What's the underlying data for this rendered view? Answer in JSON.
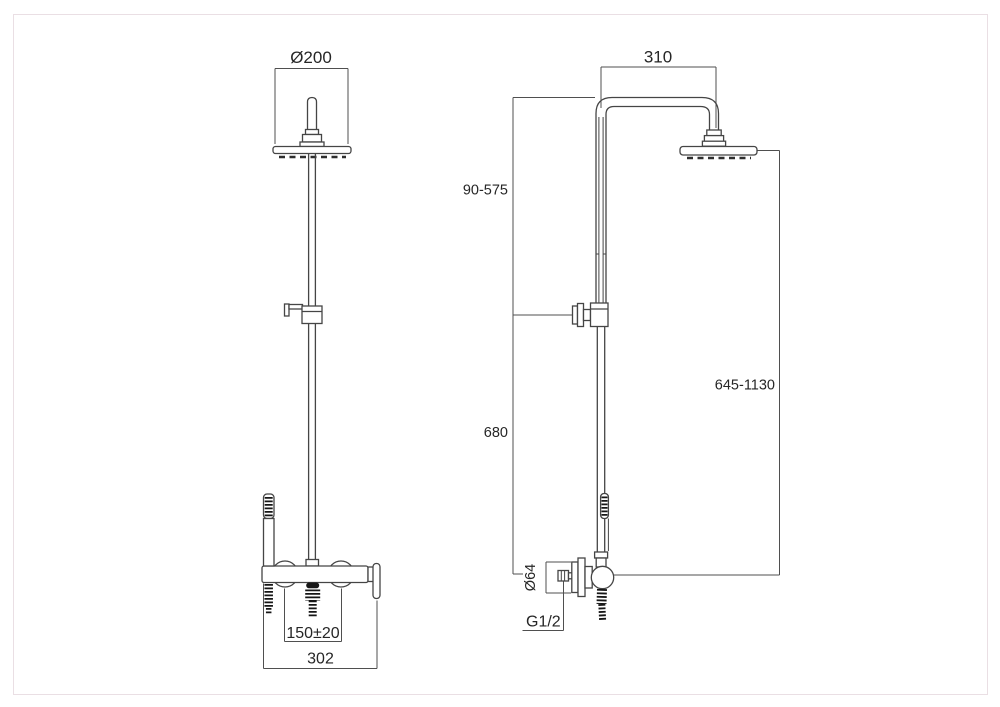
{
  "appearance": {
    "background": "#ffffff",
    "frame_color": "#eadfe4",
    "line_color": "#454545",
    "dim_line_color": "#4f4f4f",
    "text_color": "#262626",
    "dark_fill": "#161616"
  },
  "front_view": {
    "dims": {
      "head_diameter": "Ø200",
      "inlet_spacing": "150±20",
      "mixer_width": "302"
    }
  },
  "side_view": {
    "dims": {
      "arm_projection": "310",
      "upper_height_range": "90-575",
      "lower_height": "680",
      "total_height_range": "645-1130",
      "flange_diameter": "Ø64",
      "thread_size": "G1/2"
    }
  }
}
